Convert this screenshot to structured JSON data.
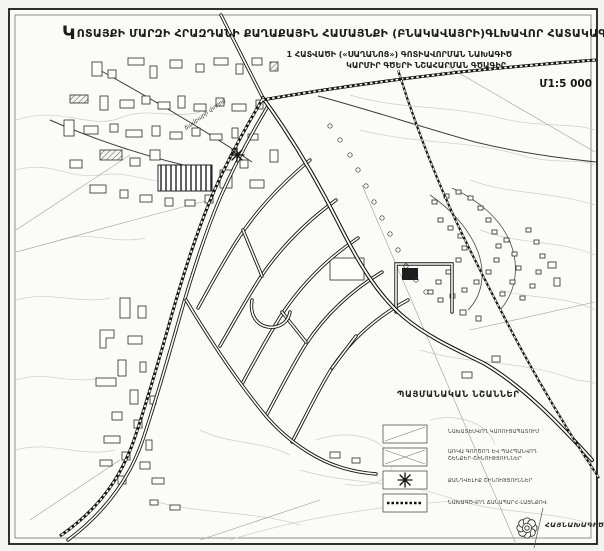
{
  "header": {
    "title_dropcap": "Կ",
    "title": "ՈՏԱՅՔԻ ՄԱՐԶԻ ՀՐԱԶԴԱՆԻ ՔԱՂԱՔԱՅԻՆ ՀԱՄԱՅՆՔԻ (ԲՆԱԿԱՎԱՅՐԻ)ԳԼԽԱՎՈՐ ՀԱՏԱԿԱԳԻԾ",
    "subtitle_line1": "1 ՀԱՏՎԱԾԻ («ՍԱՂԱՆՈՑ») ԳՈՏԻԱՎՈՐՄԱՆ ՆԱԽԱԳԻԾ",
    "subtitle_line2": "ԿԱՐՄԻՐ ԳԾԵՐԻ ՆՇԱՀԱՐՄԱՆ ԳԾԱԳԻՐ",
    "scale_label": "Մ1:5 000"
  },
  "map": {
    "street_label": "ճամբարի փողոց",
    "symbols": {
      "landmark": "eight-point-star",
      "railway": "hatched-double-line",
      "road": "double-line"
    }
  },
  "legend": {
    "header": "ՊԱՅՄԱՆԱԿԱՆ ՆՇԱՆՆԵՐ",
    "items": [
      {
        "symbol": "light-hatched-box",
        "label": "ՆԱԽԱՏԵՍՎՈՂ ԿԱՌՈՒՑԱՊԱՏՈՒՄ",
        "label2": ""
      },
      {
        "symbol": "dense-hatched-box",
        "label": "ԱՌԿԱ ԳՈՐԾՈՂ ԵՎ ՊԱՀՊԱՆՎՈՂ",
        "label2": "ՇԵՆՔԵՐ-ՇԻՆՈՒԹՅՈՒՆՆԵՐ"
      },
      {
        "symbol": "asterisk",
        "label": "ՔԱՆԴՎԵԼԻՔ ՇԻՆՈՒԹՅՈՒՆՆԵՐ",
        "label2": ""
      },
      {
        "symbol": "dotted-line-box",
        "label": "ՆԱԽԱԳԾՎՈՂ ՃԱՆԱՊԱՐՀ-ԼԱՅՆՔՈՎ",
        "label2": ""
      }
    ]
  },
  "footer": {
    "organization": "ՀԱՅՆԱԽԱԳԻԾ",
    "logo": "rosette-emblem"
  },
  "colors": {
    "ink": "#1a1a1a",
    "contour": "#cdcdca",
    "paper": "#f3f3f0"
  }
}
